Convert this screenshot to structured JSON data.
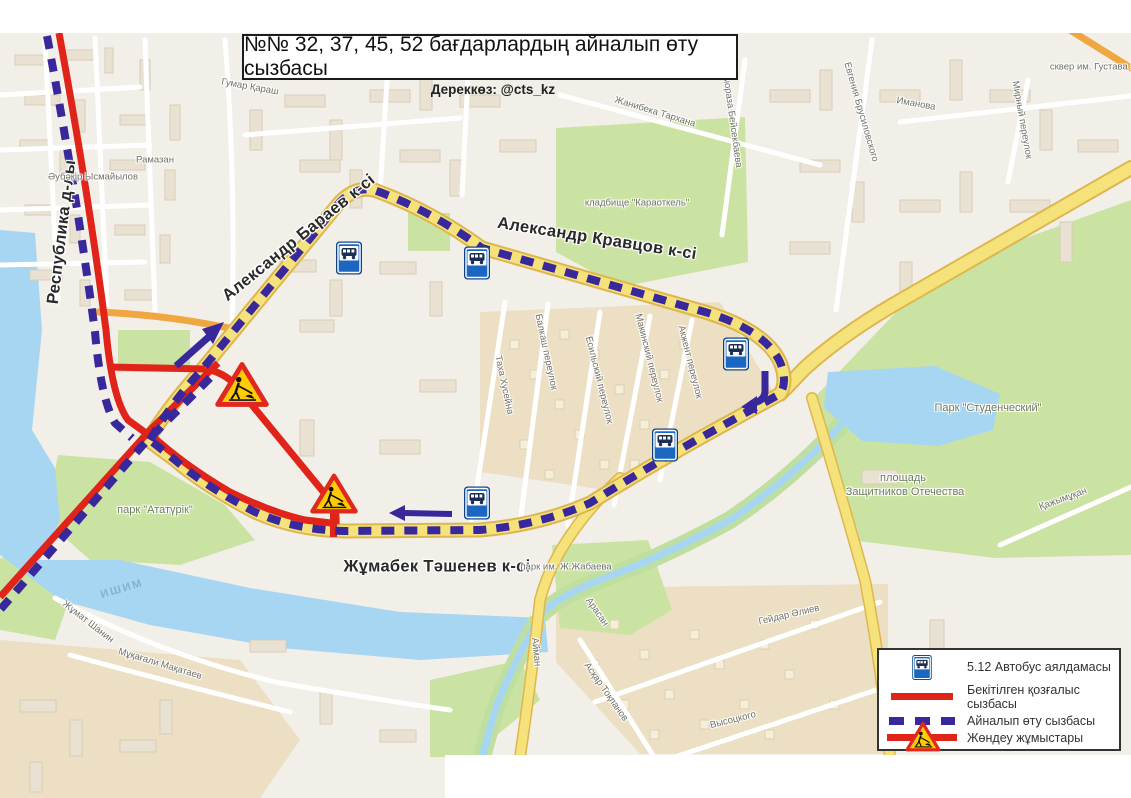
{
  "header": {
    "title": "№№ 32, 37, 45, 52 бағдарлардың айналып өту сызбасы",
    "source": "Дереккөз: @cts_kz"
  },
  "legend": {
    "items": [
      {
        "icon": "bus-stop-sign",
        "label": "5.12 Автобус аялдамасы"
      },
      {
        "icon": "solid-red-line",
        "label": "Бекітілген қозғалыс сызбасы"
      },
      {
        "icon": "dashed-purple-line",
        "label": "Айналып өту сызбасы"
      },
      {
        "icon": "roadworks-sign",
        "label": "Жөндеу жұмыстары"
      }
    ]
  },
  "map": {
    "street_labels": [
      {
        "text": "Республика д-лы",
        "x": 62,
        "y": 232,
        "rot": -83,
        "cls": "major"
      },
      {
        "text": "Александр Бараев к-сі",
        "x": 299,
        "y": 238,
        "rot": -39,
        "cls": "major"
      },
      {
        "text": "Александр Кравцов к-сі",
        "x": 597,
        "y": 239,
        "rot": 9,
        "cls": "major"
      },
      {
        "text": "Жұмабек Тәшенев к-сі",
        "x": 437,
        "y": 567,
        "rot": 0,
        "cls": "major"
      }
    ],
    "area_labels": [
      {
        "text": "кладбище \"Караоткель\"",
        "x": 637,
        "y": 203,
        "rot": 0,
        "cls": "minor"
      },
      {
        "text": "парк \"Ататүрік\"",
        "x": 155,
        "y": 510,
        "rot": 0,
        "cls": "park"
      },
      {
        "text": "Парк \"Студенческий\"",
        "x": 988,
        "y": 408,
        "rot": 0,
        "cls": "park"
      },
      {
        "text": "площадь",
        "x": 903,
        "y": 478,
        "rot": 0,
        "cls": "park"
      },
      {
        "text": "Защитников Отечества",
        "x": 905,
        "y": 492,
        "rot": 0,
        "cls": "park"
      },
      {
        "text": "парк им. Ж.Жабаева",
        "x": 566,
        "y": 567,
        "rot": 0,
        "cls": "minor"
      },
      {
        "text": "сквер им. Густава З",
        "x": 1093,
        "y": 67,
        "rot": 0,
        "cls": "minor"
      },
      {
        "text": "ИШИМ",
        "x": 122,
        "y": 589,
        "rot": -16,
        "cls": "water"
      },
      {
        "text": "Қажымұқан",
        "x": 1063,
        "y": 499,
        "rot": -20,
        "cls": "minor"
      },
      {
        "text": "Гейдар Әлиев",
        "x": 789,
        "y": 615,
        "rot": -13,
        "cls": "minor"
      },
      {
        "text": "Высоцкого",
        "x": 733,
        "y": 720,
        "rot": -14,
        "cls": "minor"
      },
      {
        "text": "Асқар Тоқпанов",
        "x": 606,
        "y": 692,
        "rot": 55,
        "cls": "minor"
      },
      {
        "text": "Жанибека Тархана",
        "x": 655,
        "y": 112,
        "rot": 17,
        "cls": "minor"
      },
      {
        "text": "Евгения Брусиловского",
        "x": 861,
        "y": 112,
        "rot": 74,
        "cls": "minor"
      },
      {
        "text": "Иманова",
        "x": 916,
        "y": 104,
        "rot": 10,
        "cls": "minor"
      },
      {
        "text": "Бақтыораза Бейсекбаева",
        "x": 731,
        "y": 112,
        "rot": 82,
        "cls": "minor"
      },
      {
        "text": "Таха Хусейна",
        "x": 504,
        "y": 385,
        "rot": 78,
        "cls": "minor"
      },
      {
        "text": "Балкаш переулок",
        "x": 546,
        "y": 352,
        "rot": 78,
        "cls": "minor"
      },
      {
        "text": "Есильский переулок",
        "x": 599,
        "y": 380,
        "rot": 76,
        "cls": "minor"
      },
      {
        "text": "Макинский переулок",
        "x": 649,
        "y": 358,
        "rot": 76,
        "cls": "minor"
      },
      {
        "text": "Акжент переулок",
        "x": 690,
        "y": 362,
        "rot": 76,
        "cls": "minor"
      },
      {
        "text": "Мирный переулок",
        "x": 1022,
        "y": 120,
        "rot": 80,
        "cls": "minor"
      },
      {
        "text": "Гумар Қараш",
        "x": 250,
        "y": 87,
        "rot": 10,
        "cls": "minor"
      },
      {
        "text": "Әубәкір Ысмайылов",
        "x": 93,
        "y": 177,
        "rot": 0,
        "cls": "minor"
      },
      {
        "text": "Рамазан",
        "x": 155,
        "y": 160,
        "rot": 0,
        "cls": "minor"
      },
      {
        "text": "Айман",
        "x": 536,
        "y": 652,
        "rot": 84,
        "cls": "minor"
      },
      {
        "text": "Арасан",
        "x": 597,
        "y": 612,
        "rot": 55,
        "cls": "minor"
      },
      {
        "text": "Жұмат Шанин",
        "x": 88,
        "y": 622,
        "rot": 38,
        "cls": "minor"
      },
      {
        "text": "Мұқағали Мақатаев",
        "x": 160,
        "y": 664,
        "rot": 17,
        "cls": "minor"
      }
    ],
    "bus_stops": [
      {
        "x": 349,
        "y": 258
      },
      {
        "x": 477,
        "y": 263
      },
      {
        "x": 736,
        "y": 354
      },
      {
        "x": 665,
        "y": 445
      },
      {
        "x": 477,
        "y": 503
      }
    ],
    "roadworks": [
      {
        "x": 242,
        "y": 385,
        "size": 54
      },
      {
        "x": 334,
        "y": 494,
        "size": 48
      }
    ]
  },
  "colors": {
    "route_red": "#e02419",
    "detour_purple": "#38289b",
    "road_yellow": "#f5e27a",
    "road_orange": "#f0a742",
    "water": "#a6d6f2",
    "park_green": "#cbe3a2",
    "map_background": "#f2efe9",
    "sign_blue": "#1a66c0",
    "sign_yellow": "#ffcb05"
  }
}
